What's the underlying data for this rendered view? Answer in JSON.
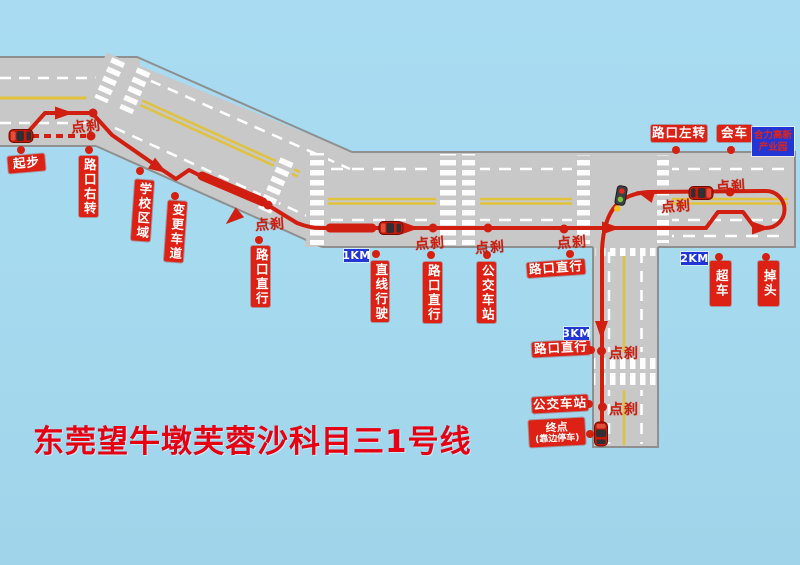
{
  "title": "东莞望牛墩芙蓉沙科目三1号线",
  "brake_label": "点刹",
  "km_markers": {
    "km1": "1KM",
    "km2": "2KM",
    "km3": "3KM"
  },
  "park_badge": {
    "line1": "合力高新",
    "line2": "产业园"
  },
  "stops": {
    "start": "起步",
    "turn_right": "路口右转",
    "school_zone": "学校区域",
    "change_lane": "变更车道",
    "straight_1": "路口直行",
    "straight_drive": "直线行驶",
    "straight_2": "路口直行",
    "bus_stop_1": "公交车站",
    "straight_3": "路口直行",
    "overtake": "超车",
    "u_turn": "掉头",
    "turn_left": "路口左转",
    "meet_vehicle": "会车",
    "straight_4": "路口直行",
    "bus_stop_2": "公交车站",
    "end_line1": "终点",
    "end_line2": "(靠边停车)"
  },
  "icons": {
    "car": "car-icon",
    "traffic_light": "traffic-light-icon",
    "route_dot": "route-dot",
    "direction_arrow": "direction-arrow"
  },
  "colors": {
    "water_blue": "#a5d9ee",
    "road_gray": "#c8c8c8",
    "road_border": "#8f8f8f",
    "lane_yellow": "#e0c23c",
    "route_red": "#d01f10",
    "label_red": "#dd2114",
    "badge_blue": "#2236d6",
    "title_red": "#e60012"
  }
}
